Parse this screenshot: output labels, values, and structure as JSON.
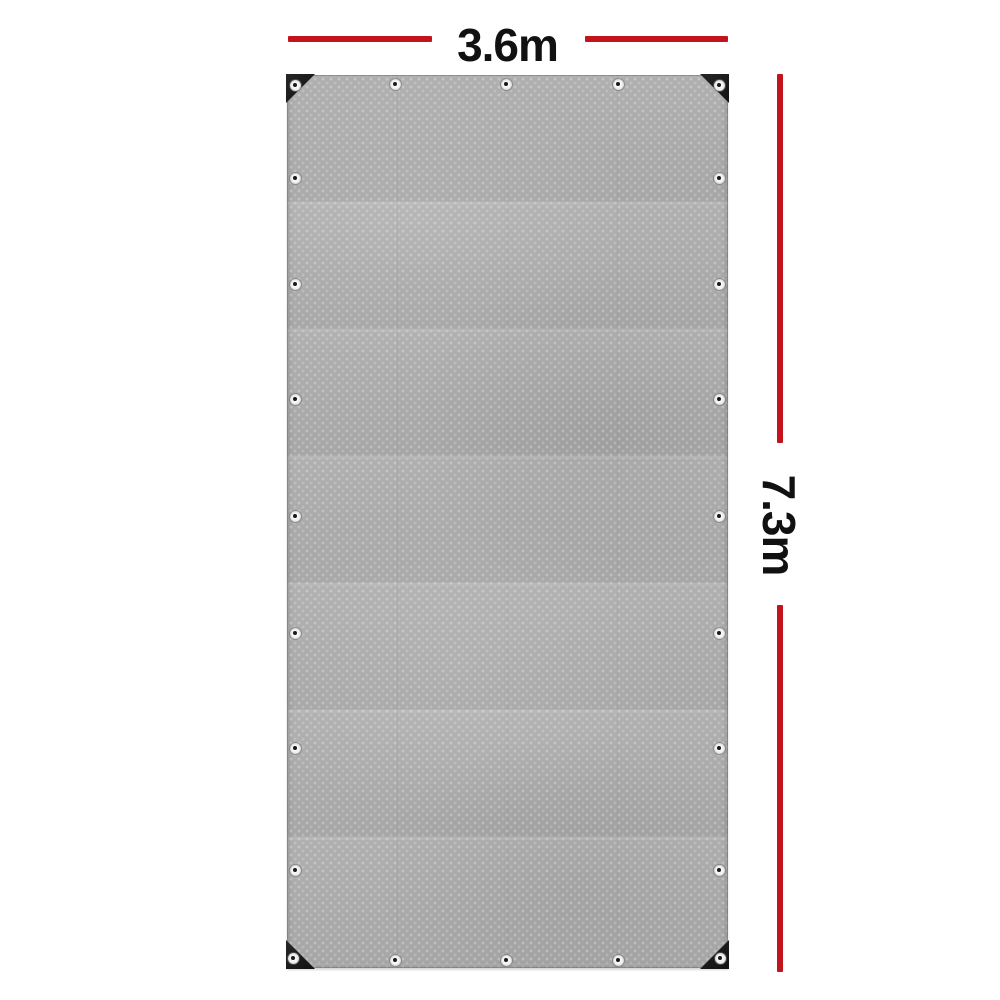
{
  "product_figure": {
    "description_visible_text_only": true,
    "width_dimension": {
      "label": "3.6m"
    },
    "height_dimension": {
      "label": "7.3m"
    },
    "annotation_colors": {
      "dimension_line": "#c3131c",
      "dimension_text": "#111111"
    },
    "tarp": {
      "base_color": "#afafaf",
      "corner_patch_color": "#1a1a1a",
      "eyelet_outer_color": "#f6f6f6",
      "eyelet_hole_color": "#1a1a1a",
      "eyelet_positions": [
        [
          295,
          85
        ],
        [
          719,
          85
        ],
        [
          293,
          958
        ],
        [
          720,
          958
        ],
        [
          395,
          84
        ],
        [
          506,
          84
        ],
        [
          618,
          84
        ],
        [
          395,
          960
        ],
        [
          506,
          960
        ],
        [
          618,
          960
        ],
        [
          295,
          178
        ],
        [
          295,
          284
        ],
        [
          295,
          399
        ],
        [
          295,
          516
        ],
        [
          295,
          633
        ],
        [
          295,
          748
        ],
        [
          295,
          870
        ],
        [
          719,
          178
        ],
        [
          719,
          284
        ],
        [
          719,
          399
        ],
        [
          719,
          516
        ],
        [
          719,
          633
        ],
        [
          719,
          748
        ],
        [
          719,
          870
        ]
      ]
    },
    "dimension_geometry": {
      "top_bars": [
        {
          "left": 288,
          "top": 36,
          "width": 144
        },
        {
          "left": 585,
          "top": 36,
          "width": 143
        }
      ],
      "right_bars": [
        {
          "left": 777,
          "top": 74,
          "height": 369
        },
        {
          "left": 777,
          "top": 605,
          "height": 367
        }
      ]
    }
  }
}
